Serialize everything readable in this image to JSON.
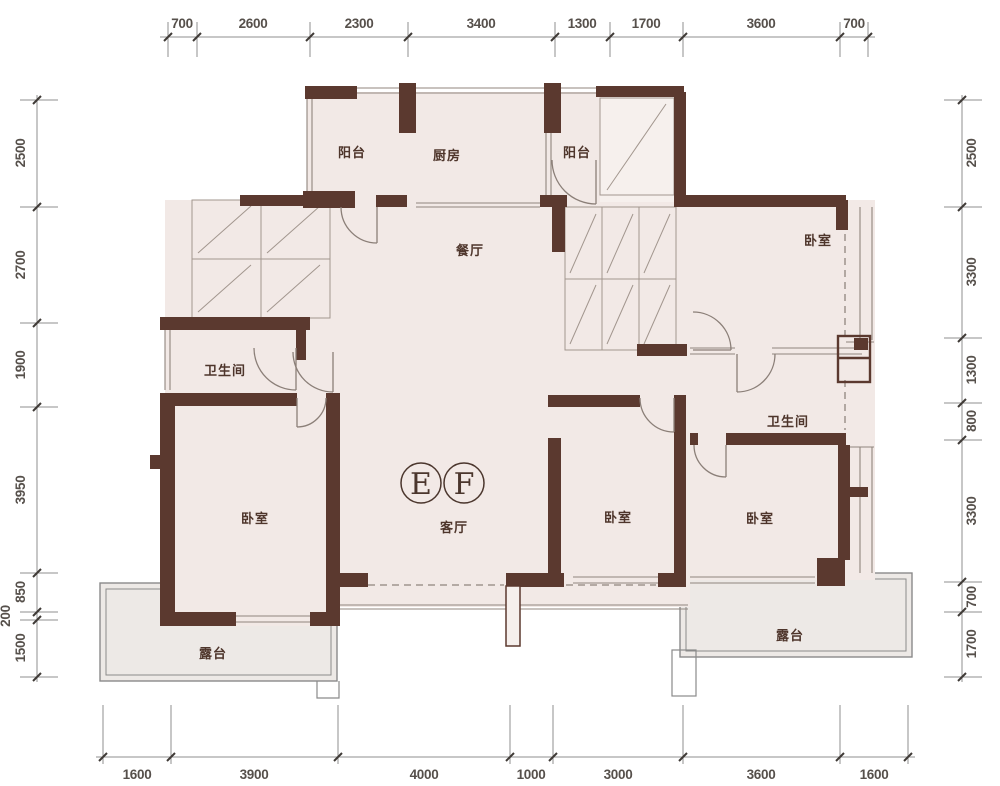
{
  "unit": {
    "e": "E",
    "f": "F"
  },
  "rooms": {
    "balcony_left": "阳台",
    "kitchen": "厨房",
    "balcony_top_right": "阳台",
    "dining": "餐厅",
    "bedroom_top_right": "卧室",
    "bathroom_left": "卫生间",
    "bedroom_left": "卧室",
    "living": "客厅",
    "bedroom_middle": "卧室",
    "bathroom_right": "卫生间",
    "bedroom_right": "卧室",
    "terrace_left": "露台",
    "terrace_right": "露台"
  },
  "dimensions": {
    "top": [
      "700",
      "2600",
      "2300",
      "3400",
      "1300",
      "1700",
      "3600",
      "700"
    ],
    "bottom": [
      "1600",
      "3900",
      "4000",
      "1000",
      "3000",
      "3600",
      "1600"
    ],
    "left": [
      "2500",
      "2700",
      "1900",
      "3950",
      "850",
      "200",
      "1500"
    ],
    "right": [
      "2500",
      "3300",
      "1300",
      "800",
      "3300",
      "700",
      "1700"
    ]
  },
  "colors": {
    "wall": "#5b392f",
    "floor": "#f2e9e6",
    "void_floor": "#f6f0ed",
    "terrace": "#ede9e6",
    "dim_text": "#56504b",
    "room_text": "#4e352b",
    "thin_line": "#90857e",
    "hatch_line": "#a2968e"
  }
}
